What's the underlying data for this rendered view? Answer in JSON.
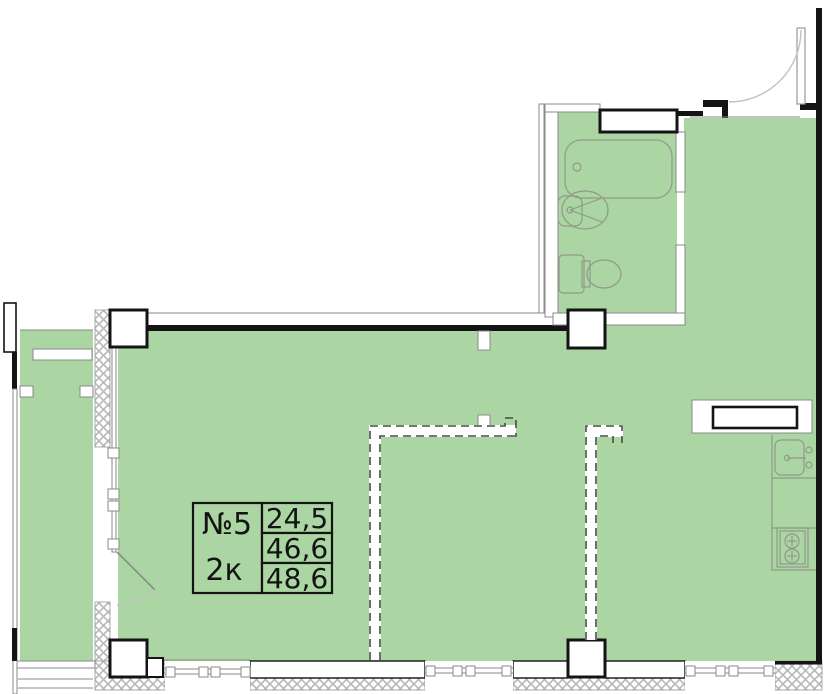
{
  "title": "Apartment floor plan",
  "colors": {
    "floor": "#abd5a2",
    "wall": "#141414",
    "line": "#8a8a8a",
    "hatch": "#b8b8b8",
    "bg": "#ffffff"
  },
  "label": {
    "number": "№5",
    "rooms": "2к",
    "area_living": "24,5",
    "area_apartment": "46,6",
    "area_total": "48,6"
  },
  "icons": [
    "bathtub-icon",
    "wash-sink-icon",
    "toilet-icon",
    "kitchen-sink-icon",
    "stove-icon",
    "entry-door-arc-icon",
    "balcony-door-arc-icon"
  ]
}
